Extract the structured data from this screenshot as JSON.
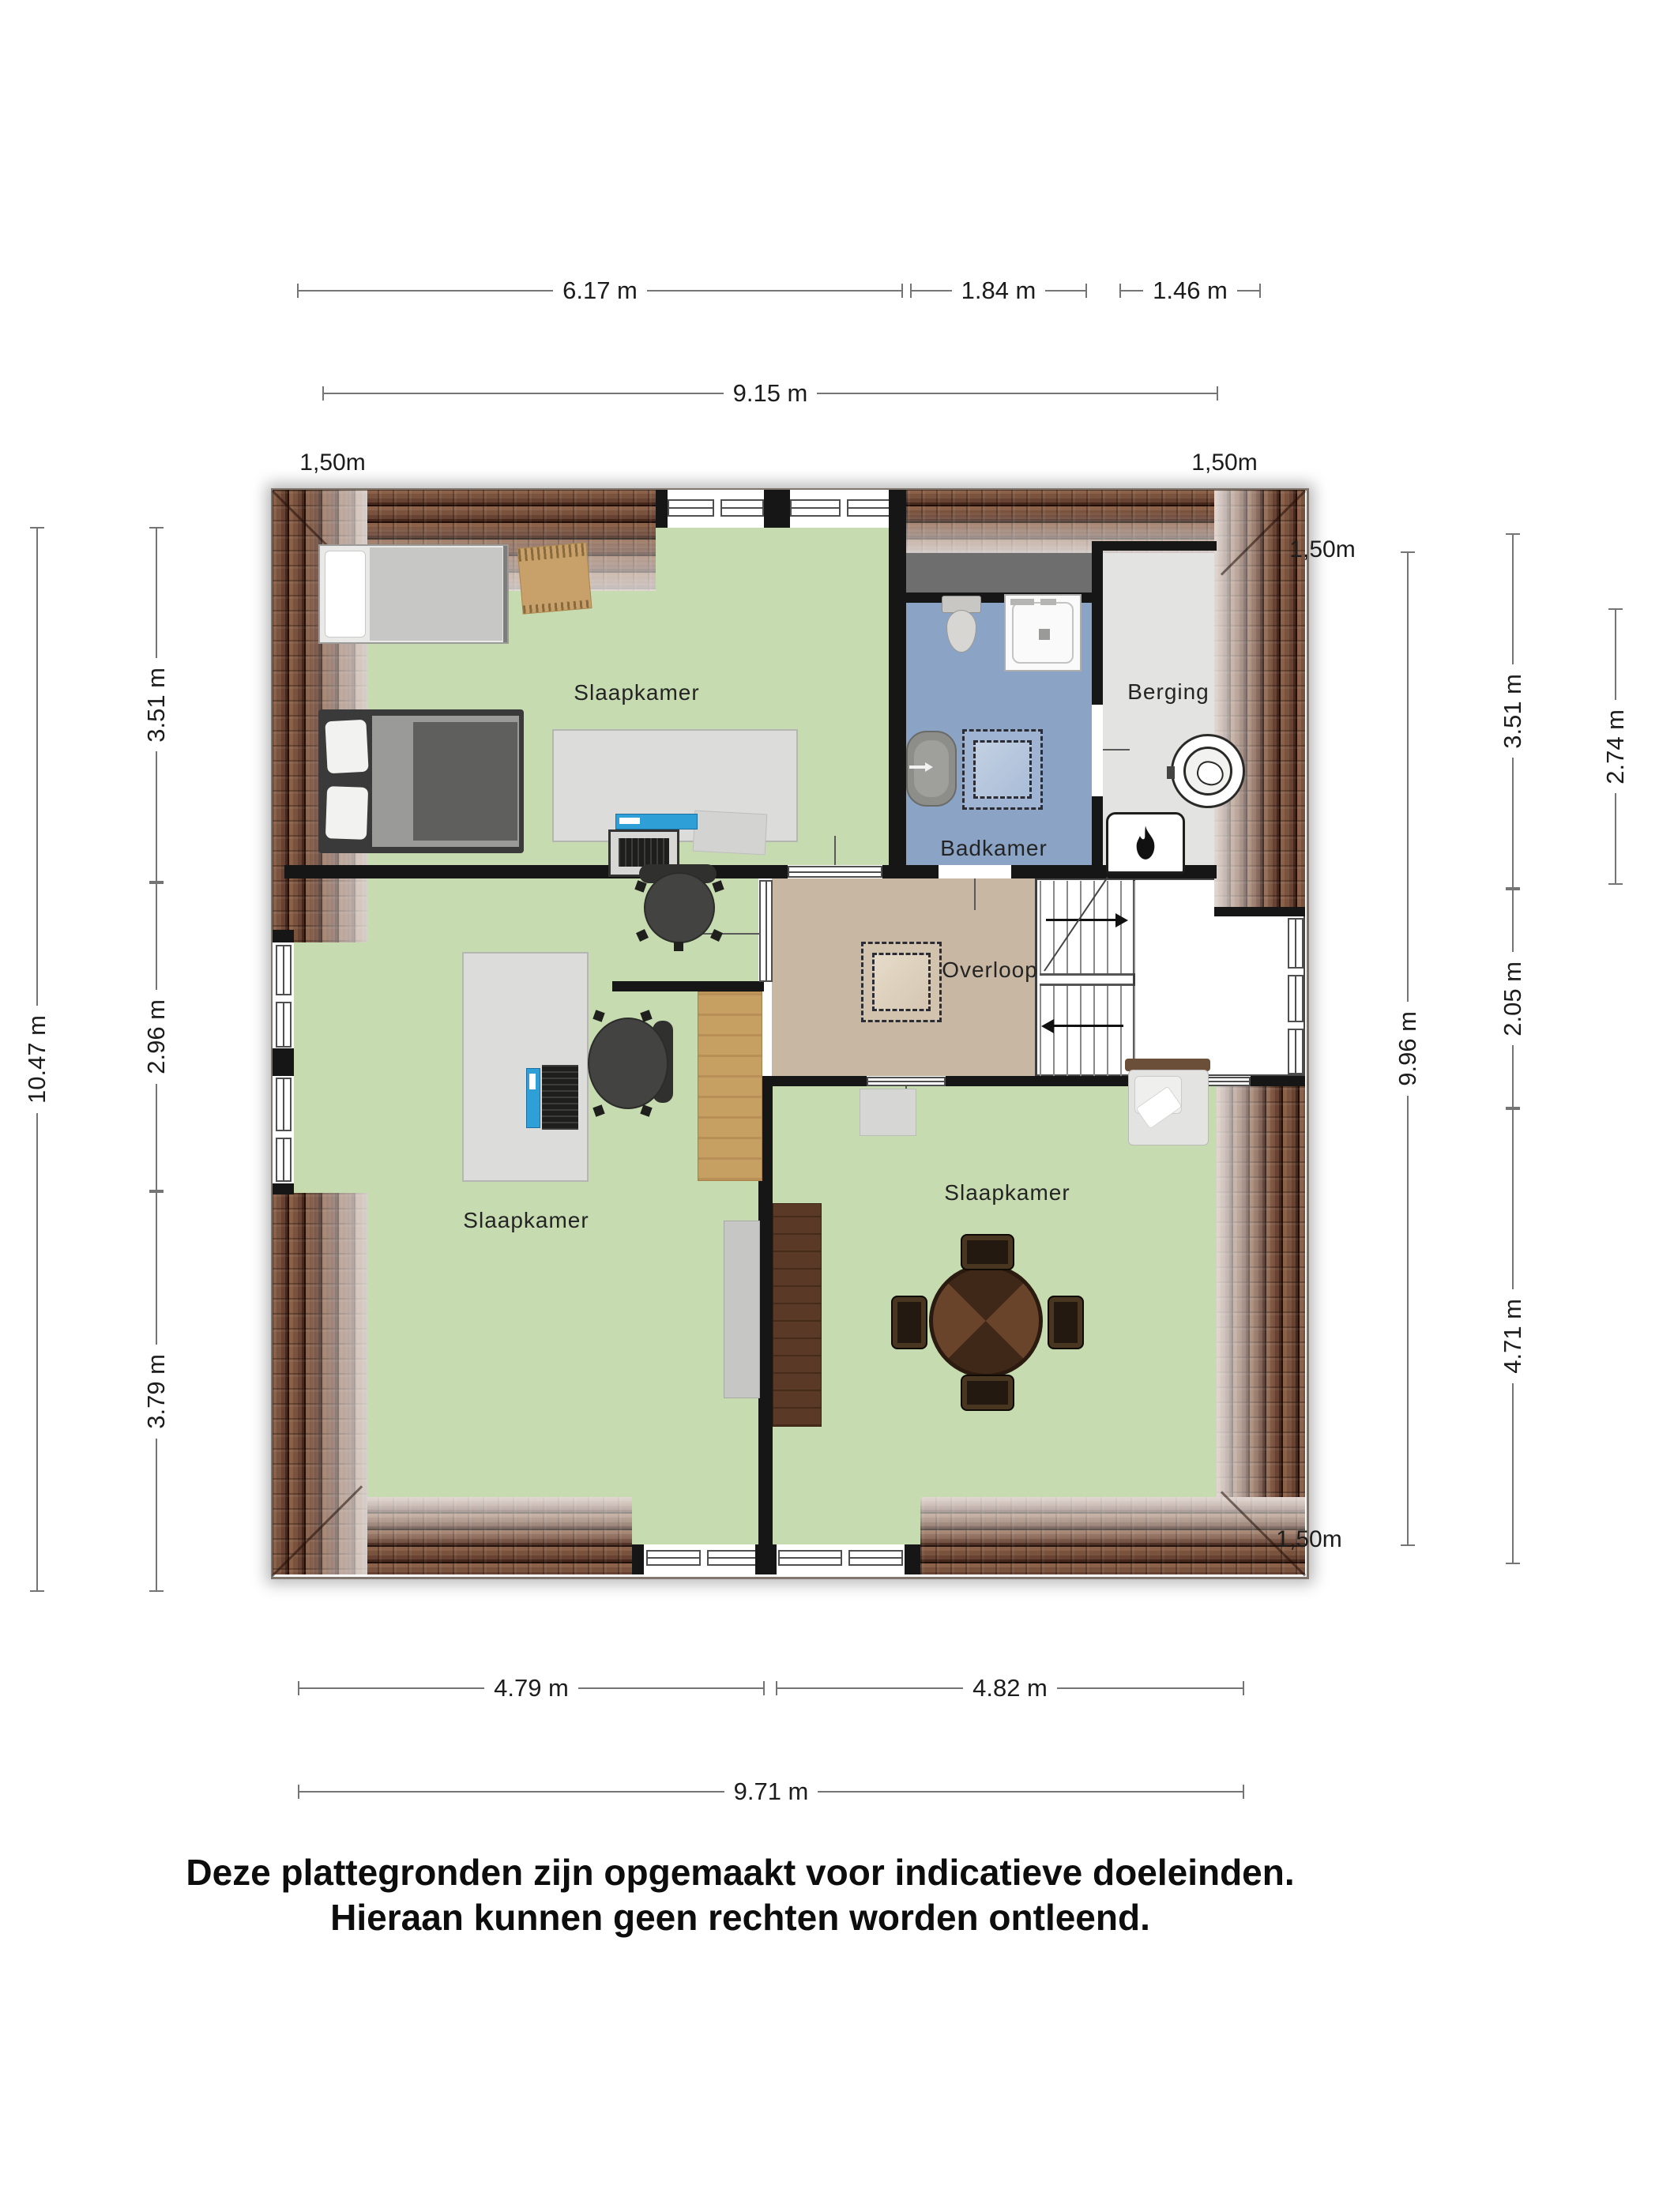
{
  "plan": {
    "type": "floorplan-first-floor",
    "rooms": [
      {
        "id": "bedroom-top",
        "label": "Slaapkamer"
      },
      {
        "id": "bedroom-left",
        "label": "Slaapkamer"
      },
      {
        "id": "bedroom-right",
        "label": "Slaapkamer"
      },
      {
        "id": "bathroom",
        "label": "Badkamer"
      },
      {
        "id": "storage",
        "label": "Berging"
      },
      {
        "id": "landing",
        "label": "Overloop"
      }
    ]
  },
  "dimensions": {
    "top_segments": [
      "6.17 m",
      "1.84 m",
      "1.46 m"
    ],
    "top_total": "9.15 m",
    "left_total": "10.47 m",
    "left_segments": [
      "3.51 m",
      "2.96 m",
      "3.79 m"
    ],
    "right_total": "9.96 m",
    "right_segments": [
      "3.51 m",
      "2.05 m",
      "4.71 m"
    ],
    "right_inner": "2.74 m",
    "bottom_segments": [
      "4.79 m",
      "4.82 m"
    ],
    "bottom_total": "9.71 m"
  },
  "height_markers": {
    "top_left": "1,50m",
    "top_right": "1,50m",
    "right_upper": "1,50m",
    "right_lower": "1,50m"
  },
  "footer": {
    "line1": "Deze plattegronden zijn opgemaakt voor indicatieve doeleinden.",
    "line2": "Hieraan kunnen geen rechten worden ontleend."
  },
  "icons": [
    "roof-window-icon",
    "washing-machine-icon",
    "water-heater-icon",
    "toilet-icon",
    "shower-icon",
    "sink-icon",
    "stairs-up-icon",
    "stairs-down-icon",
    "single-bed-icon",
    "double-bed-icon",
    "rug-icon",
    "desk-icon",
    "monitor-icon",
    "laptop-icon",
    "office-chair-icon",
    "wardrobe-icon",
    "cabinet-icon",
    "sideboard-icon",
    "dining-table-icon",
    "dining-chair-icon",
    "armchair-icon",
    "doormat-icon",
    "window-icon",
    "door-icon"
  ],
  "colors": {
    "floor_green": "#c7dbb1",
    "bathroom_blue": "#8ba4c5",
    "landing_tan": "#c8b7a2",
    "storage_gray": "#e3e3e1",
    "flat_gray": "#6e6e6e",
    "roof_brown": "#7a533f",
    "wall_black": "#161616"
  }
}
